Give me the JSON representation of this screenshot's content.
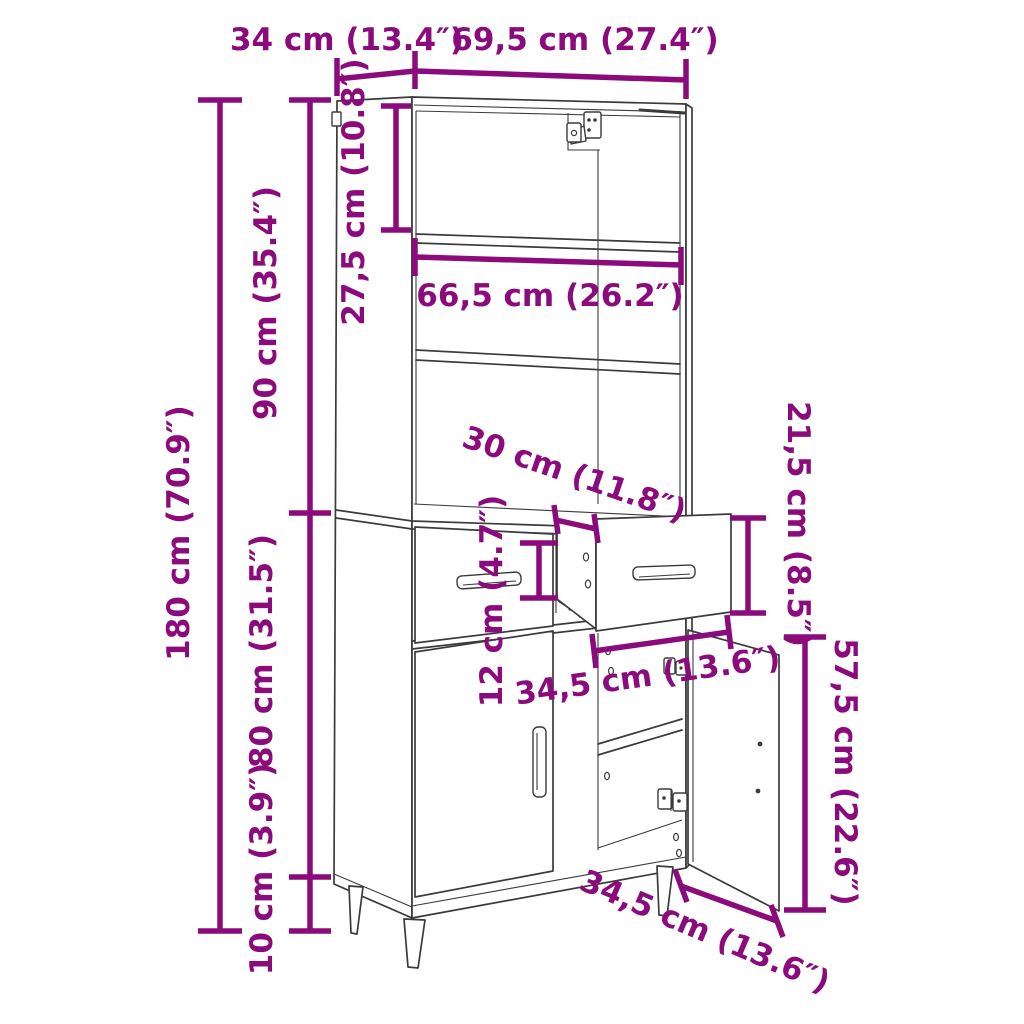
{
  "diagram": {
    "title": "Highboard furniture dimension diagram",
    "background": "#ffffff",
    "accent_color": "#8B0A7C",
    "line_color": "#3b3b3b",
    "labels": {
      "depth_top": "34 cm (13.4″)",
      "width_top": "69,5 cm (27.4″)",
      "top_compartment_height": "27,5 cm (10.8″)",
      "inner_width": "66,5 cm (26.2″)",
      "upper_height": "90 cm (35.4″)",
      "total_height": "180 cm (70.9″)",
      "drawer_depth": "30 cm (11.8″)",
      "drawer_height_outer": "21,5 cm (8.5″)",
      "drawer_front_height": "12 cm (4.7″)",
      "lower_height": "80 cm (31.5″)",
      "leg_height": "10 cm (3.9″)",
      "drawer_width": "34,5 cm (13.6″)",
      "door_height": "57,5 cm (22.6″)",
      "door_width": "34,5 cm (13.6″)"
    }
  }
}
